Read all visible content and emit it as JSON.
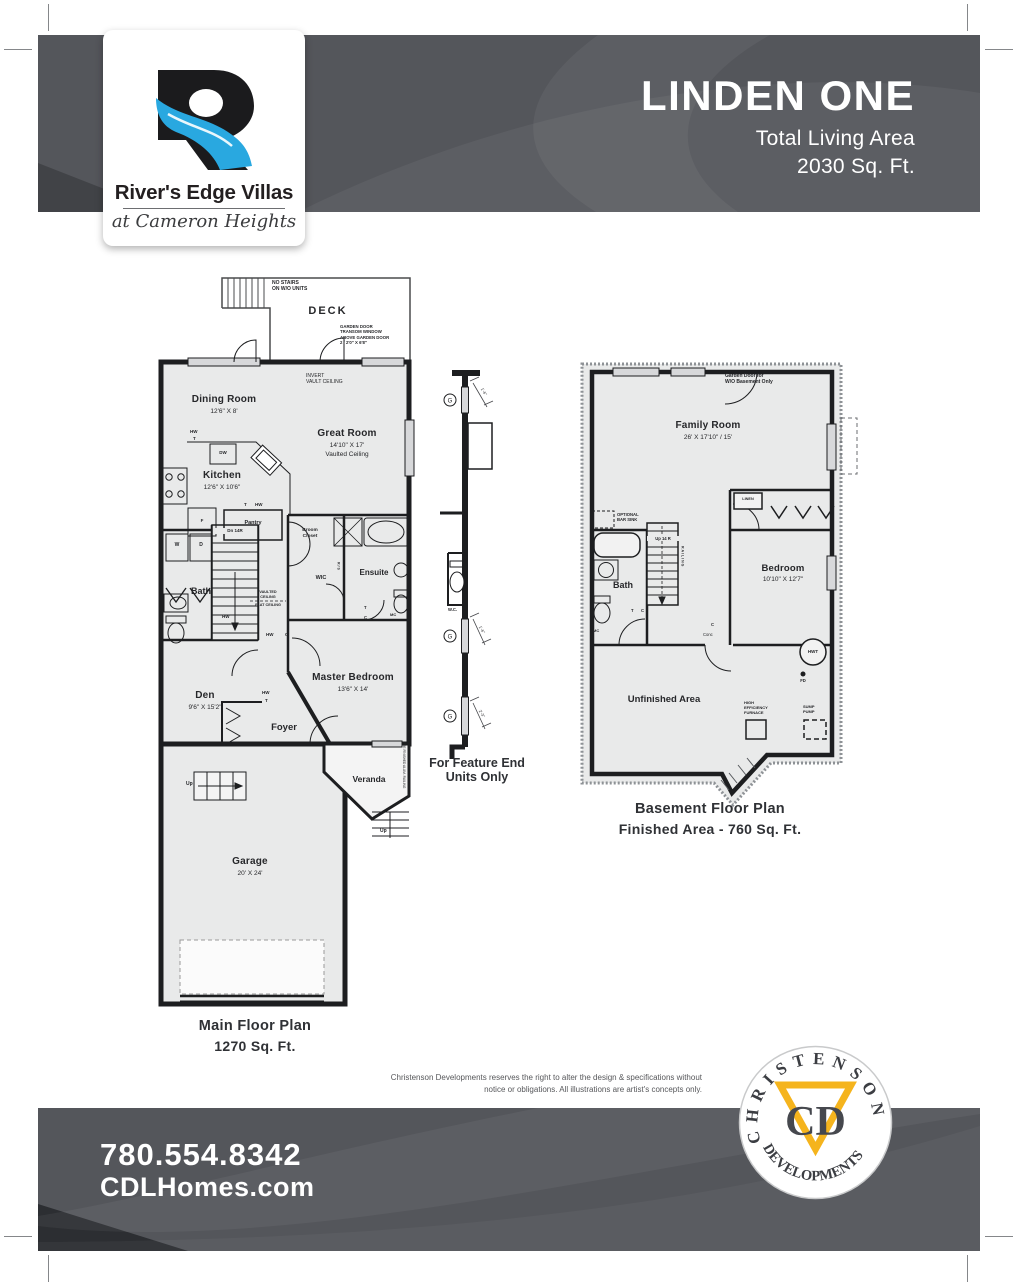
{
  "header": {
    "brand": {
      "name": "River's Edge Villas",
      "tagline": "at Cameron Heights"
    },
    "plan_name": "LINDEN ONE",
    "living_area_label": "Total Living Area",
    "living_area_value": "2030 Sq. Ft."
  },
  "main_floor": {
    "caption_title": "Main Floor Plan",
    "caption_area": "1270 Sq. Ft.",
    "deck_label": "DECK",
    "no_stairs_note": "NO STAIRS\nON W/O UNITS",
    "garden_door_note": "GARDEN DOOR\nTRANSOM WINDOW\nABOVE GARDEN DOOR\n2 / 2'0\" X 6'8\"",
    "invert_vault_note": "INVERT\nVAULT CEILING",
    "ceiling_note_vaulted": "VAULTED\nCEILING",
    "ceiling_note_flat": "FLAT CEILING",
    "railing_note": "PRE FINISHED ALUM. RAILING",
    "closet_note": "R/S",
    "rooms": {
      "dining": {
        "name": "Dining Room",
        "dim": "12'6\" X 8'"
      },
      "great": {
        "name": "Great Room",
        "dim": "14'10\" X 17'",
        "note": "Vaulted Ceiling"
      },
      "kitchen": {
        "name": "Kitchen",
        "dim": "12'6\" X 10'6\""
      },
      "master": {
        "name": "Master Bedroom",
        "dim": "13'6\" X 14'"
      },
      "den": {
        "name": "Den",
        "dim": "9'6\" X 15'2\""
      },
      "garage": {
        "name": "Garage",
        "dim": "20' X 24'"
      },
      "bath": "Bath",
      "ensuite": "Ensuite",
      "wic": "WIC",
      "broom_closet": "Broom\nCloset",
      "pantry": "Pantry",
      "foyer": "Foyer",
      "veranda": "Veranda"
    },
    "tags": {
      "dw": "DW",
      "f": "F",
      "w": "W",
      "d": "D",
      "hw": "HW",
      "t": "T",
      "c": "C",
      "mc": "MC",
      "up": "Up",
      "dn": "Dn 14R"
    }
  },
  "feature_end": {
    "caption": "For Feature End\nUnits Only",
    "wc_label": "W.C.",
    "glass_tag": "G",
    "dim_small": "1'-6\"",
    "dim_large": "2'-3\""
  },
  "basement": {
    "caption_title": "Basement Floor Plan",
    "caption_area": "Finished Area - 760 Sq. Ft.",
    "garden_door_note": "Garden Door for\nW/O Basement Only",
    "rooms": {
      "family": {
        "name": "Family Room",
        "dim": "26' X 17'10\" / 15'"
      },
      "bedroom": {
        "name": "Bedroom",
        "dim": "10'10\" X 12'7\""
      },
      "bath": "Bath",
      "unfinished": "Unfinished Area",
      "linen": "LINEN"
    },
    "labels": {
      "optional_bar_sink": "OPTIONAL\nBAR SINK",
      "stairs": "Up 14 R",
      "railing": "RAILING",
      "hwt": "HWT",
      "fd": "FD",
      "conc": "Conc",
      "furnace": "HIGH\nEFFICIENCY\nFURNACE",
      "sump": "SUMP\nPUMP",
      "t": "T",
      "c": "C",
      "mc": "MC"
    }
  },
  "disclaimer": "Christenson Developments reserves the right to alter the design & specifications without notice or obligations. All illustrations are artist's concepts only.",
  "footer": {
    "phone": "780.554.8342",
    "website": "CDLHomes.com"
  },
  "developer_logo": {
    "arc_top": "CHRISTENSON",
    "arc_bottom": "DEVELOPMENTS",
    "initials": "CD"
  },
  "colors": {
    "band": "#54565B",
    "accent_blue": "#29A8E0",
    "accent_gold": "#F5B41D"
  }
}
